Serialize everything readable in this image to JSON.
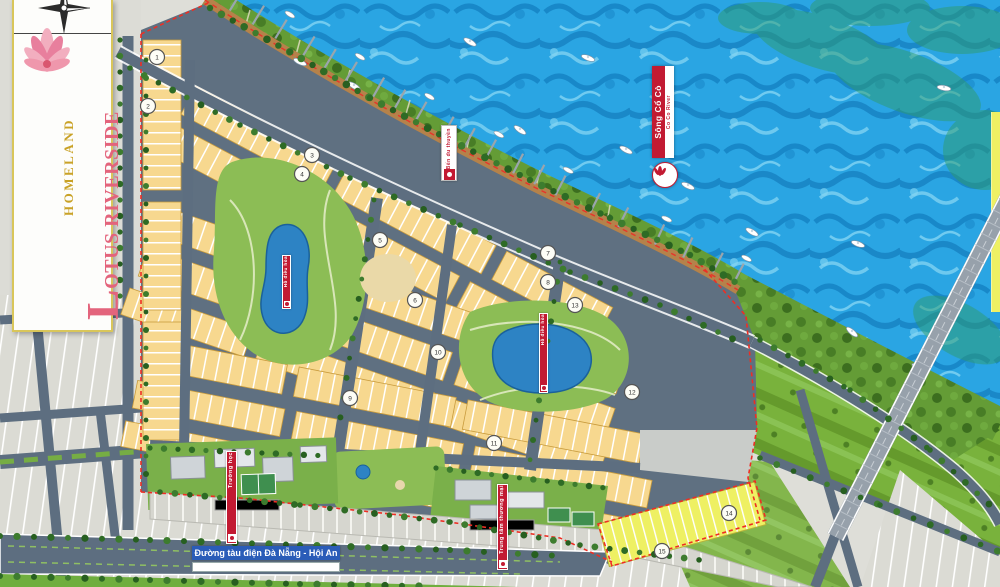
{
  "banner": {
    "brand": "HOMELAND",
    "project": "LOTUS RIVERSIDE"
  },
  "river": {
    "name": "Sông Cổ Cò",
    "name_en": "Co Co River"
  },
  "labels": {
    "marina": "Bến du thuyền",
    "lake1": "Hồ điều hòa",
    "lake2": "Hồ điều hòa",
    "facility_left": "Trường học",
    "facility_right": "Trung tâm thương mại",
    "tram": "Đường tàu điện Đà Nẵng - Hội An"
  },
  "markers": [
    "1",
    "2",
    "3",
    "4",
    "5",
    "6",
    "7",
    "8",
    "9",
    "10",
    "11",
    "12",
    "13",
    "14",
    "15"
  ],
  "colors": {
    "water": "#2aa5e3",
    "block_cream": "#f7d88f",
    "block_yellow": "#eef063",
    "road": "#5d6e80",
    "boundary_red": "#ee2e24",
    "banner_red": "#c21a32",
    "brand_gold": "#c9a227",
    "brand_pink": "#e3647c",
    "tram_label_blue": "#2a5cb8"
  }
}
